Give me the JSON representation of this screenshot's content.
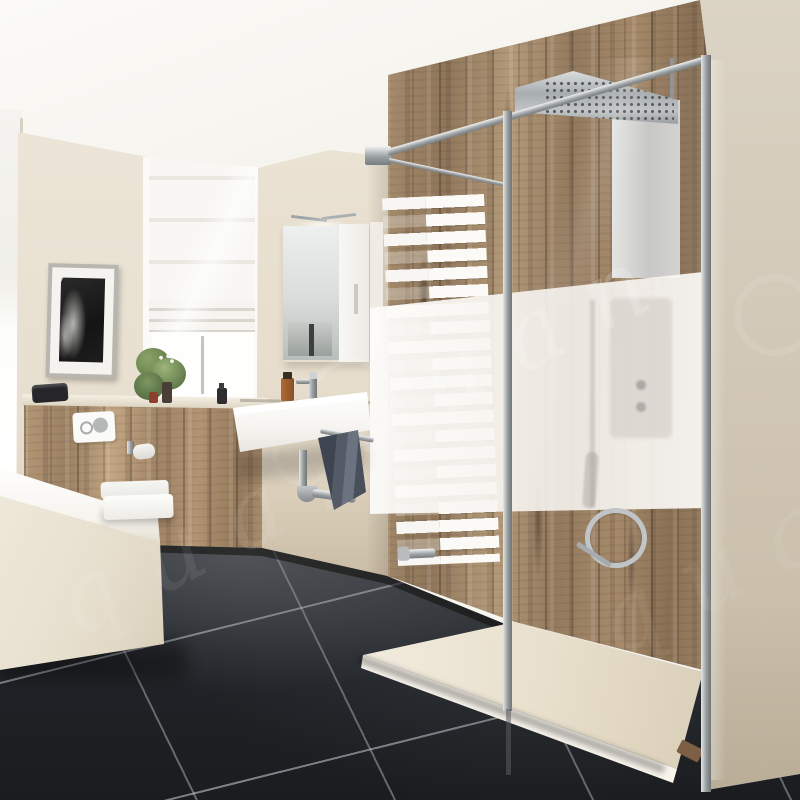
{
  "image": {
    "kind": "bathroom interior photograph",
    "width_px": 800,
    "height_px": 800
  },
  "watermark": {
    "text": "quan",
    "color": "#ffffff",
    "angle_deg": -27,
    "style": "repeated diagonal semi-transparent text with circular logo outlines"
  },
  "palette": {
    "ceiling": "#f8f6f1",
    "left_wall": "#e9e2d3",
    "center_wall": "#e9e1d1",
    "right_wall": "#d3c9b8",
    "wood_mid": "#9b8164",
    "wood_light": "#c3ab8a",
    "wood_dark": "#4a3b2c",
    "floor_tile": "#232529",
    "grout": "#b8bdc2",
    "fixture_white": "#f8f6f0",
    "frosted_glass": "#f4f2ed",
    "chrome": "#b9bcbf",
    "towel_dark": "#4e5560",
    "plant_green": "#5c7a46",
    "amber_bottle": "#9a5b2d",
    "drain_bronze": "#7d5f45"
  },
  "scene": {
    "objects": [
      "ceiling",
      "window with roman blind (far left)",
      "window with roman blind (recessed)",
      "framed black-and-white picture",
      "mirror cabinet with light",
      "wall-hung wash basin with mixer tap",
      "chrome bottle trap",
      "grey towels on rail",
      "wall-hung toilet",
      "flush plate",
      "toilet paper holder",
      "bathtub",
      "wood plank accent wall",
      "wood wainscot half wall",
      "white towel radiator",
      "walk-in shower glass panel with frosted privacy band",
      "chrome support rails and posts",
      "rain shower head with perforations",
      "shower column",
      "hand shower with coiled hose",
      "low-profile shower tray with drain",
      "black floor tiles with light grout",
      "green plant on sill",
      "toiletry bottles and bag"
    ]
  }
}
